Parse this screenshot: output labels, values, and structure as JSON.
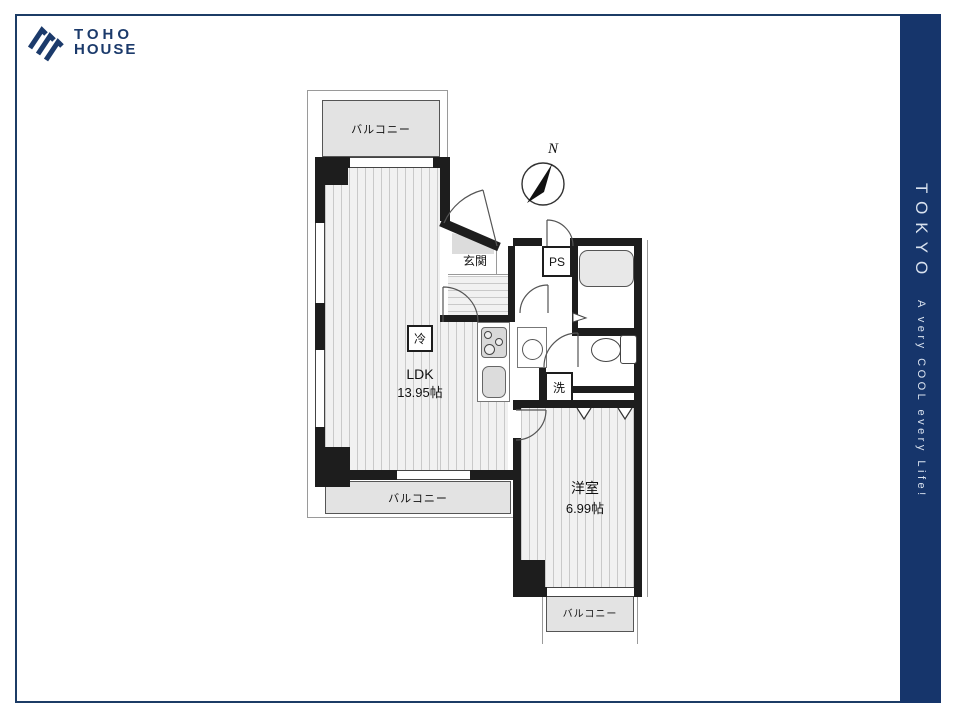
{
  "brand": {
    "line1": "TOHO",
    "line2": "HOUSE"
  },
  "sidebar": {
    "city": "TOKYO",
    "tagline": "A very COOL every Life!"
  },
  "plan": {
    "compass_north": "N",
    "labels": {
      "balcony_top": "バルコニー",
      "balcony_ldk": "バルコニー",
      "balcony_west": "バルコニー",
      "entrance": "玄関",
      "pipe_space": "PS",
      "fridge": "冷",
      "washer": "洗",
      "ldk_name": "LDK",
      "ldk_size": "13.95帖",
      "west_room_name": "洋室",
      "west_room_size": "6.99帖"
    },
    "colors": {
      "wall": "#1d1d1d",
      "balcony_fill": "#e3e3e3",
      "floor_fill": "#f1f1f1",
      "accent_navy": "#1b3a6b",
      "sidebar_navy": "#16356b"
    }
  }
}
